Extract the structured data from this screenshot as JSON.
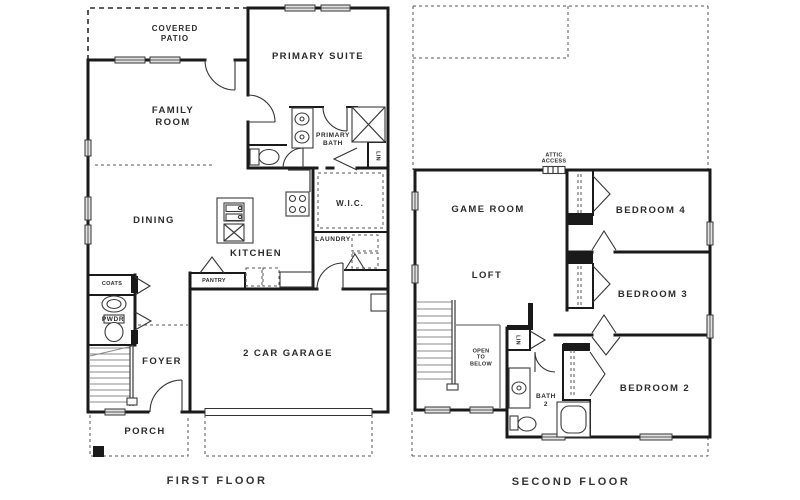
{
  "colors": {
    "wall": "#1a1a1a",
    "text": "#2b2b2b",
    "window_fill": "#e2e2e2",
    "stair_gray": "#8a8a8a",
    "background": "#ffffff"
  },
  "first_floor": {
    "caption": "FIRST FLOOR",
    "rooms": {
      "covered_patio": "COVERED\nPATIO",
      "primary_suite": "PRIMARY SUITE",
      "family_room": "FAMILY\nROOM",
      "primary_bath": "PRIMARY\nBATH",
      "linen": "LIN",
      "dining": "DINING",
      "wic": "W.I.C.",
      "kitchen": "KITCHEN",
      "laundry": "LAUNDRY",
      "coats": "COATS",
      "pantry": "PANTRY",
      "powder": "PWDR",
      "foyer": "FOYER",
      "garage": "2 CAR GARAGE",
      "porch": "PORCH"
    }
  },
  "second_floor": {
    "caption": "SECOND FLOOR",
    "rooms": {
      "attic_access": "ATTIC\nACCESS",
      "game_room": "GAME ROOM",
      "bedroom_4": "BEDROOM 4",
      "loft": "LOFT",
      "bedroom_3": "BEDROOM 3",
      "open_to_below": "OPEN\nTO\nBELOW",
      "linen": "LIN",
      "bath_2": "BATH\n2",
      "bedroom_2": "BEDROOM 2"
    }
  }
}
